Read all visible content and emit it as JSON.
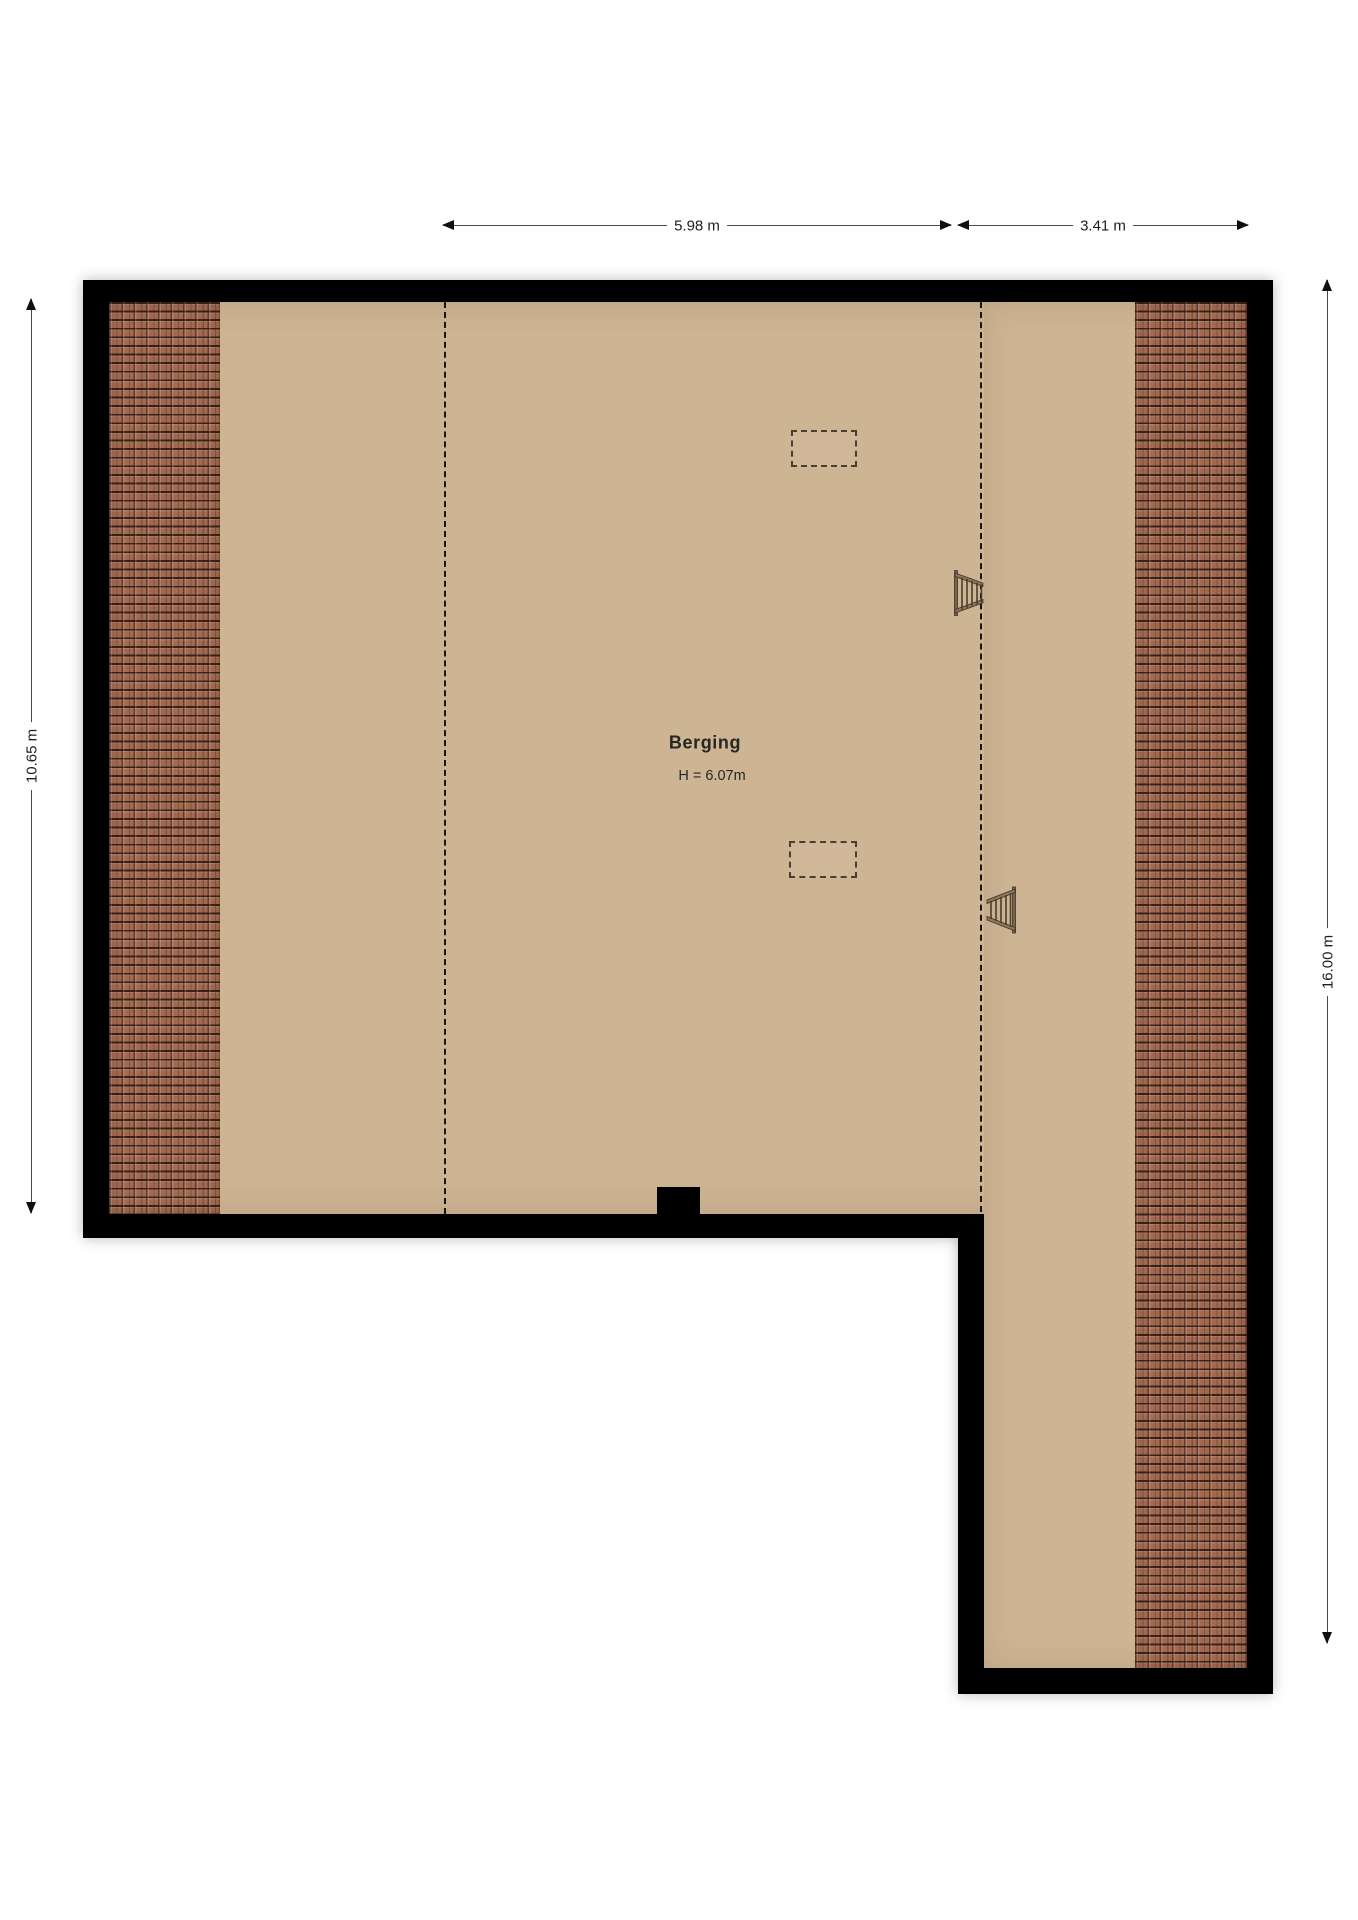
{
  "floorplan": {
    "room": {
      "label": "Berging",
      "height_label": "H = 6.07m"
    },
    "dimensions": {
      "top_main": "5.98 m",
      "top_wing": "3.41 m",
      "left": "10.65 m",
      "right": "16.00 m"
    },
    "colors": {
      "wall": "#000000",
      "floor": "#cdb493",
      "roof_tile": "#a2694f",
      "dimension_line": "#4a4a4a",
      "background": "#ffffff"
    },
    "icons": {
      "skylight": "dashed-rectangle roof window",
      "ladder": "wooden loft ladder"
    }
  }
}
